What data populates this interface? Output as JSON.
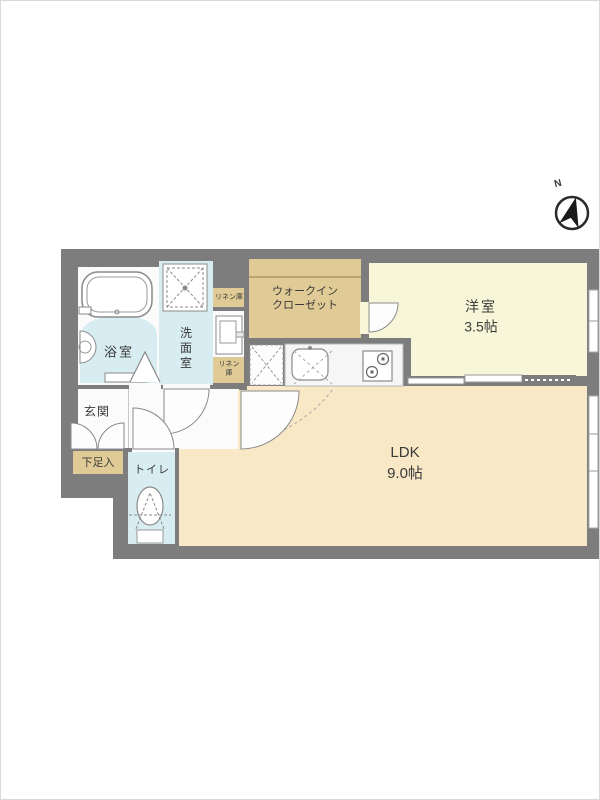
{
  "floorplan": {
    "compass": {
      "label": "N"
    },
    "rooms": {
      "bath": {
        "label": "浴室"
      },
      "washroom": {
        "label": "洗面室"
      },
      "linen_upper": {
        "label": "リネン庫"
      },
      "linen_lower": {
        "line1": "リネン",
        "line2": "庫"
      },
      "walk_in_closet": {
        "line1": "ウォークイン",
        "line2": "クローゼット"
      },
      "western_room": {
        "label": "洋室",
        "size": "3.5帖"
      },
      "ldk": {
        "label": "LDK",
        "size": "9.0帖"
      },
      "entrance": {
        "label": "玄関"
      },
      "shoe_box": {
        "label": "下足入"
      },
      "toilet": {
        "label": "トイレ"
      }
    },
    "colors": {
      "wall": "#7d7d7d",
      "water_rooms": "#d8edf1",
      "storage_tan": "#e0cb96",
      "western_room": "#f8f6d8",
      "ldk": "#f8e8c6",
      "floor_white": "#fbfbfb"
    },
    "fixtures": [
      "bathtub",
      "washing-machine-pan",
      "vanity-sink",
      "kitchen-sink",
      "gas-stove",
      "toilet-bowl",
      "sliding-door",
      "north-compass"
    ]
  }
}
